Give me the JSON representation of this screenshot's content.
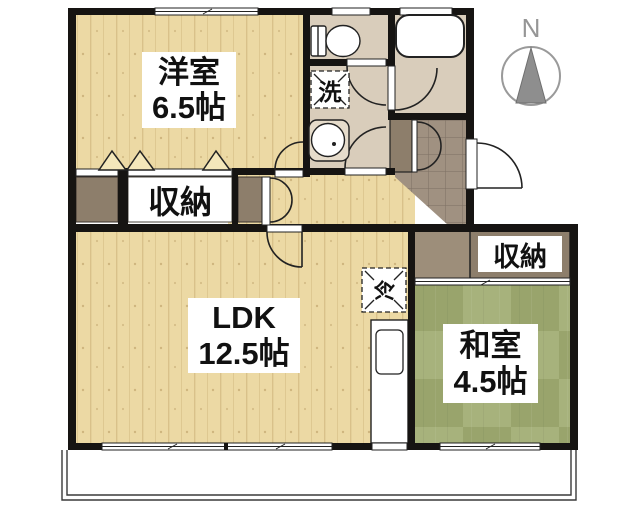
{
  "title": "apartment-floor-plan",
  "colors": {
    "wall": "#161412",
    "wood": "#ecd9a4",
    "wet": "#d9cdbb",
    "tile": "#a09181",
    "closet": "#8d7e6b",
    "closet_light": "#9d8e7a",
    "tatami": "#a7b27c",
    "tatami_dark": "#99a46c",
    "label_bg": "#ffffff",
    "text": "#111111",
    "compass": "#969696"
  },
  "rooms": {
    "western": {
      "name": "洋室",
      "size": "6.5帖"
    },
    "ldk": {
      "name": "LDK",
      "size": "12.5帖"
    },
    "japanese": {
      "name": "和室",
      "size": "4.5帖"
    },
    "storage_hall": {
      "label": "収納"
    },
    "storage_east": {
      "label": "収納"
    }
  },
  "fixtures": {
    "laundry": "洗",
    "fridge": "冷"
  },
  "compass": {
    "label": "N"
  }
}
